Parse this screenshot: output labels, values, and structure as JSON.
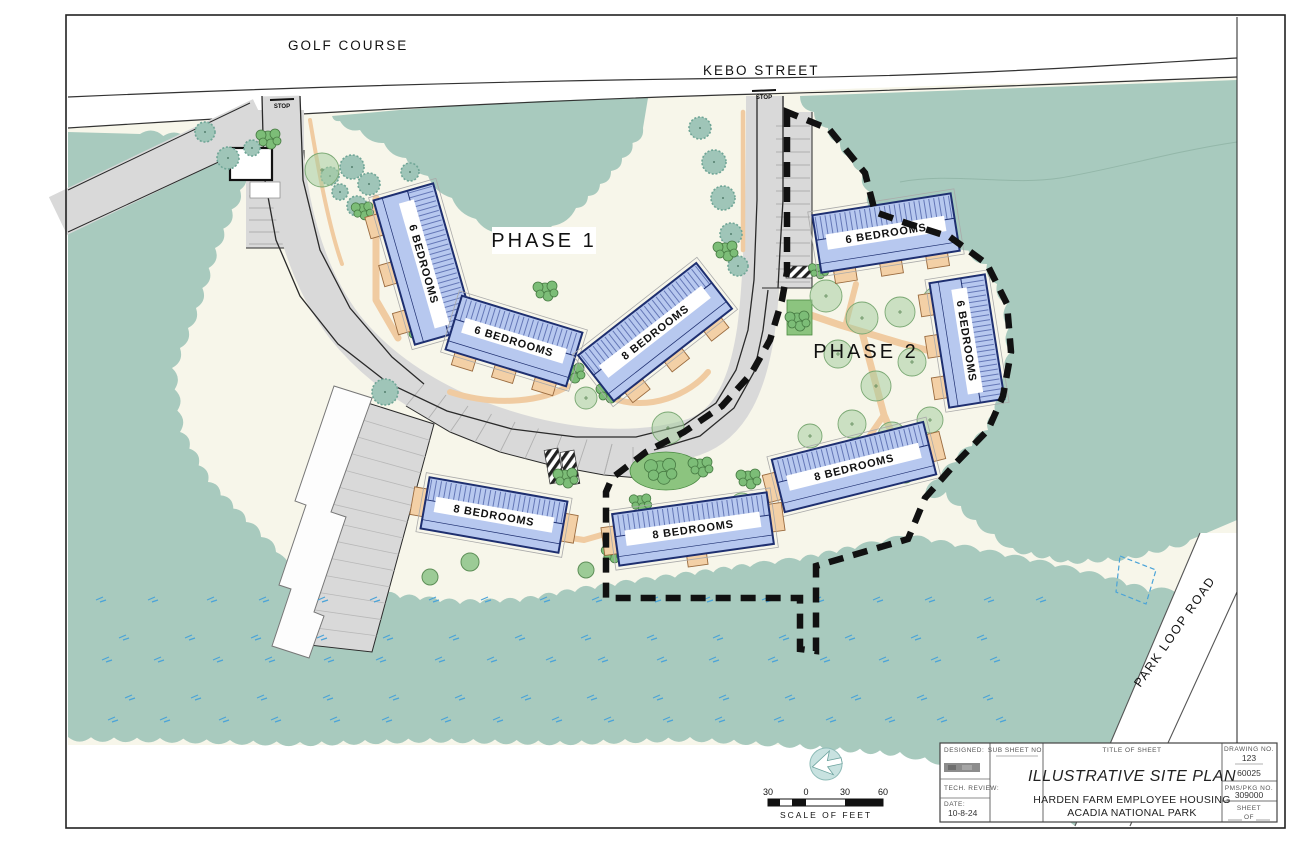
{
  "map": {
    "golf_course_label": "GOLF COURSE",
    "kebo_street_label": "KEBO STREET",
    "park_loop_road_label": "PARK LOOP ROAD",
    "phase_1_label": "PHASE 1",
    "phase_2_label": "PHASE 2",
    "stop_marking": "STOP"
  },
  "buildings": [
    {
      "label": "6 BEDROOMS",
      "bedrooms": 6,
      "phase": 1
    },
    {
      "label": "6 BEDROOMS",
      "bedrooms": 6,
      "phase": 1
    },
    {
      "label": "8 BEDROOMS",
      "bedrooms": 8,
      "phase": 1
    },
    {
      "label": "6 BEDROOMS",
      "bedrooms": 6,
      "phase": 2
    },
    {
      "label": "6 BEDROOMS",
      "bedrooms": 6,
      "phase": 2
    },
    {
      "label": "8 BEDROOMS",
      "bedrooms": 8,
      "phase": 2
    },
    {
      "label": "8 BEDROOMS",
      "bedrooms": 8,
      "phase": 2
    },
    {
      "label": "8 BEDROOMS",
      "bedrooms": 8,
      "phase": 1
    }
  ],
  "scale_bar": {
    "ticks": [
      "30",
      "0",
      "30",
      "60"
    ],
    "caption": "SCALE OF FEET"
  },
  "title_block": {
    "designed_label": "DESIGNED:",
    "tech_review_label": "TECH. REVIEW:",
    "date_label": "DATE:",
    "date_value": "10-8-24",
    "sub_sheet_label": "SUB SHEET NO.",
    "title_of_sheet_label": "TITLE OF SHEET",
    "sheet_title": "ILLUSTRATIVE SITE PLAN",
    "project_name_line1": "HARDEN FARM EMPLOYEE HOUSING",
    "project_name_line2": "ACADIA NATIONAL PARK",
    "drawing_no_label": "DRAWING NO.",
    "drawing_no_value": "123",
    "project_no_value": "60025",
    "pms_pkg_label": "PMS/PKG NO.",
    "pms_pkg_value": "309000",
    "sheet_label": "SHEET",
    "of_label": "OF"
  },
  "colors": {
    "forest": "#a8cabe",
    "lawn": "#f7f6ea",
    "road": "#d9d9d9",
    "building_fill": "#b7c8ef",
    "building_outline": "#1e2f70",
    "path_tan": "#f0cba1",
    "shrub_green": "#7cbd77",
    "boundary": "#111111",
    "marsh_tick": "#4aa3d8"
  }
}
